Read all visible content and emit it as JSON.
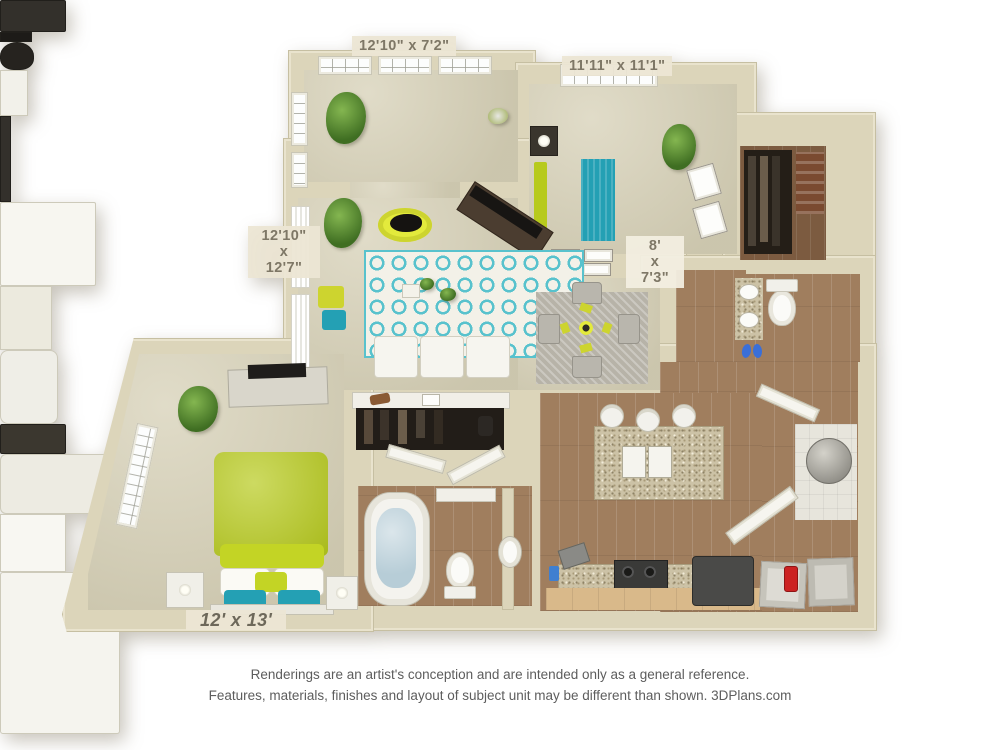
{
  "floorplan": {
    "dimension_labels": {
      "sunroom": "12'10\" x 7'2\"",
      "bedroom_top": "11'11\" x 11'1\"",
      "living": {
        "w": "12'10\"",
        "x": "x",
        "h": "12'7\""
      },
      "hall_bath": {
        "w": "8'",
        "x": "x",
        "h": "7'3\""
      },
      "bedroom_bottom": "12' x 13'"
    },
    "rooms": [
      "sunroom-office",
      "bedroom-top",
      "walk-in-closet",
      "bathroom-top",
      "living-room",
      "dining-area",
      "hall-closet",
      "bedroom-bottom",
      "bathroom-bottom",
      "kitchen",
      "entry-hall",
      "laundry",
      "water-heater-closet"
    ],
    "colors": {
      "wall": "#dcd5ba",
      "carpet": "#d6d0b6",
      "wood_floor": "#a07e5e",
      "accent_teal": "#24a0b4",
      "accent_lime": "#b7ca1d",
      "bath_water": "#b7cdd7",
      "granite": "#ccc2a6"
    }
  },
  "footer": {
    "line1": "Renderings are an artist's conception and are intended only as a general reference.",
    "line2": "Features, materials, finishes and layout of subject unit may be different than shown. 3DPlans.com"
  }
}
